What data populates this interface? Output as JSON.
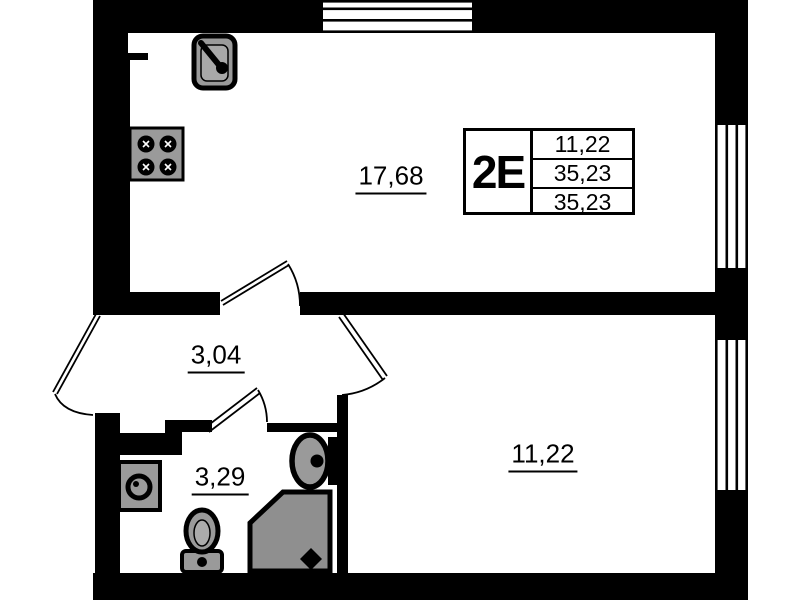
{
  "plan": {
    "type": "apartment-floor-plan",
    "unit_card": {
      "unit_label": "2E",
      "rows": [
        "11,22",
        "35,23",
        "35,23"
      ]
    },
    "rooms": [
      {
        "id": "living-kitchen",
        "area": "17,68"
      },
      {
        "id": "hallway",
        "area": "3,04"
      },
      {
        "id": "bathroom",
        "area": "3,29"
      },
      {
        "id": "bedroom",
        "area": "11,22"
      }
    ],
    "fixtures": [
      "kitchen-sink",
      "stove",
      "washing-machine",
      "toilet",
      "shower",
      "bathroom-sink"
    ],
    "windows": [
      "top-wall-window",
      "right-wall-upper-window",
      "right-wall-lower-window"
    ],
    "doors": [
      "entrance-door",
      "living-room-door",
      "bedroom-door",
      "bathroom-door"
    ],
    "colors": {
      "wall": "#000000",
      "background": "#ffffff",
      "fixture_fill": "#9a9a9a",
      "shower_fill": "#8f8f8f",
      "text": "#000000"
    }
  }
}
